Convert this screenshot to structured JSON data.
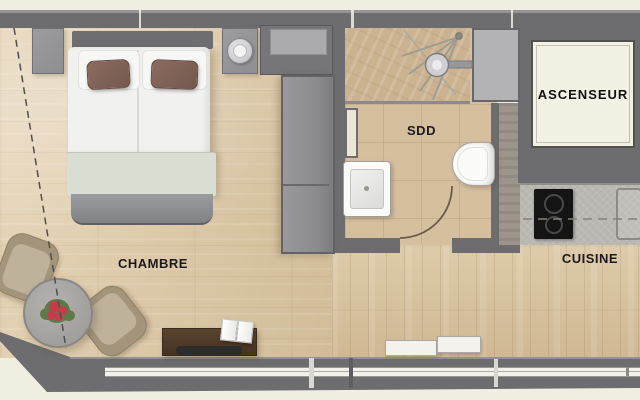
{
  "plan": {
    "rooms": {
      "bedroom_label": "CHAMBRE",
      "shower_room_label": "SDD",
      "elevator_label": "ASCENSEUR",
      "kitchen_label": "CUISINE"
    },
    "furniture_items": [
      "double-bed",
      "white-pillows",
      "accent-pillows",
      "blanket",
      "nightstand",
      "table-lamp",
      "wall-cabinet",
      "wardrobe",
      "shower-head",
      "shower-spray",
      "towel-rail",
      "washbasin",
      "toilet",
      "door-swing-arc",
      "elevator-cab",
      "kitchen-counter",
      "cooktop",
      "kitchen-sink",
      "dining-table",
      "flower-centerpiece",
      "chair",
      "sideboard",
      "open-book",
      "tray",
      "radiator",
      "window-strip",
      "roof-slope-dashed-line"
    ],
    "colors": {
      "background": "#efeee1",
      "wall": "#6d6d6f",
      "wood_floor": "#decbaa",
      "corridor_floor": "#d7c19d",
      "bathroom_tile": "#d6bf9f",
      "elevator_cab": "#f3f1e3",
      "counter": "#bab8b3",
      "cooktop": "#141414",
      "sideboard_wood": "#4f3b2c",
      "blanket_sage": "#d9ded2",
      "pillow_brown": "#7f6257",
      "chair_taupe": "#b3a68c",
      "table_gray": "#a7a5a2",
      "flower_red": "#c63c4a",
      "flower_green": "#5f7a49",
      "label_text": "#1b1b1b"
    }
  }
}
